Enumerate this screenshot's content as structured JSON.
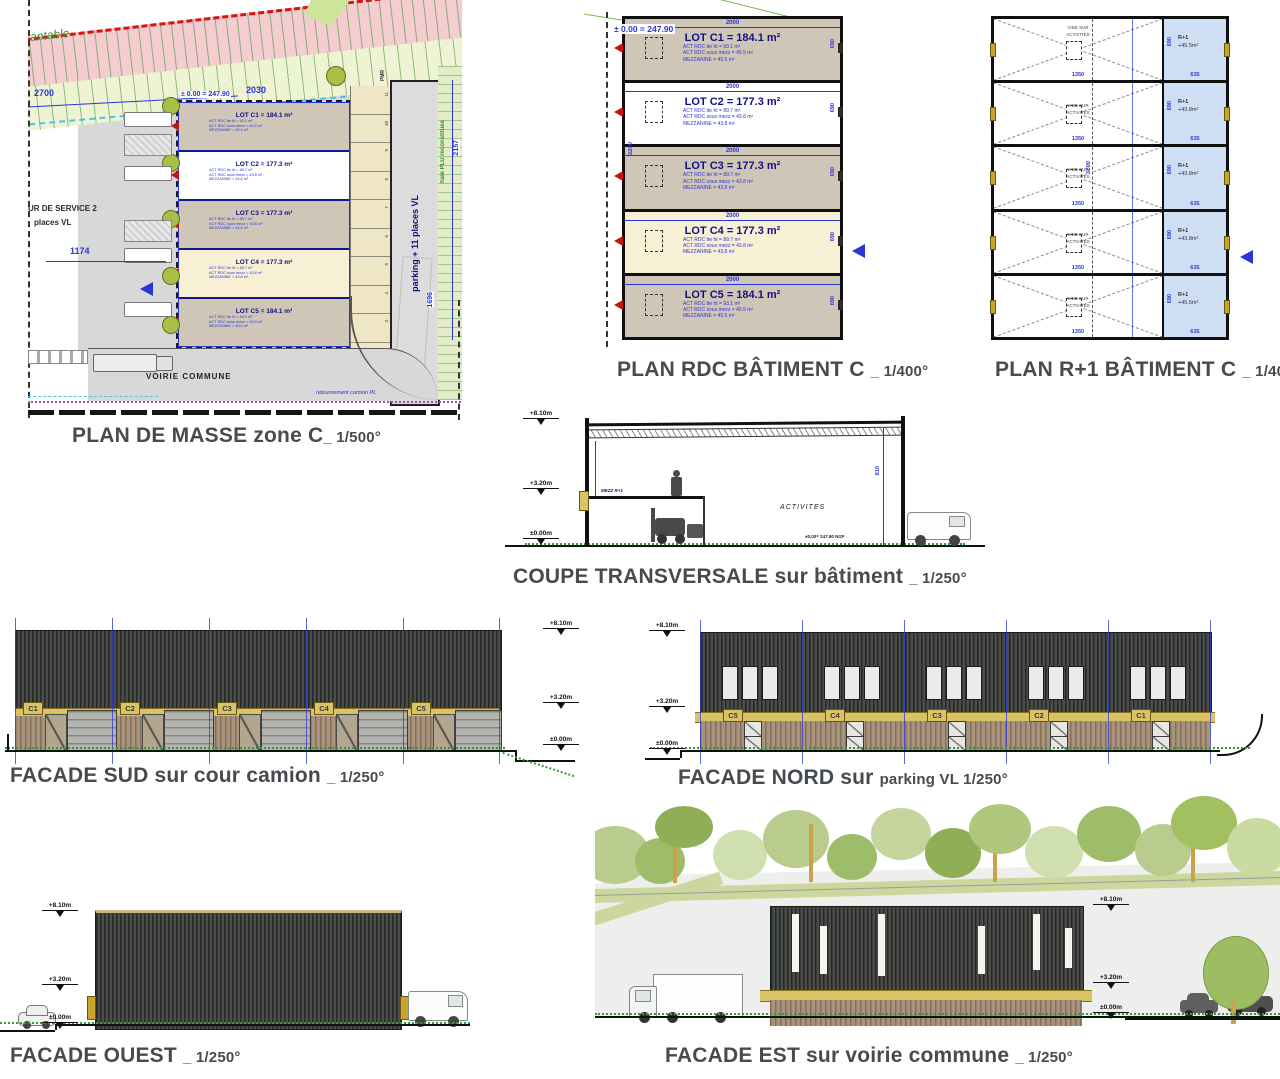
{
  "titles": {
    "masse": {
      "main": "PLAN DE MASSE zone C",
      "scale": "_ 1/500°"
    },
    "rdc": {
      "main": "PLAN RDC BÂTIMENT C ",
      "scale": "_ 1/400°"
    },
    "r1": {
      "main": "PLAN R+1 BÂTIMENT C ",
      "scale": "_ 1/400°"
    },
    "coupe": {
      "main": "COUPE TRANSVERSALE sur bâtiment ",
      "scale": "_ 1/250°"
    },
    "sud": {
      "main": "FACADE SUD sur cour camion ",
      "scale": "_ 1/250°"
    },
    "nord": {
      "main": "FACADE NORD sur ",
      "scale": "parking VL 1/250°"
    },
    "ouest": {
      "main": "FACADE OUEST ",
      "scale": "_ 1/250°"
    },
    "est": {
      "main": "FACADE EST sur voirie commune ",
      "scale": "_ 1/250°"
    }
  },
  "levels": {
    "l8": "+8.10m",
    "l3": "+3.20m",
    "l0": "±0.00m"
  },
  "masse": {
    "plantable": "antable",
    "dim_2700": "2700",
    "dim_2030": "2030",
    "dim_1174": "1174",
    "dim_2157": "2157",
    "dim_1696": "1696",
    "level": "± 0.00 = 247.90",
    "service_line1": "UR DE SERVICE 2",
    "service_line2": "places VL",
    "voirie": "VOIRIE COMMUNE",
    "retournement": "retournement camion PL",
    "parking_label": "parking + 11 places VL",
    "haie": "haie PLU reconstituée",
    "pmr": "PMR",
    "stalls": [
      "11",
      "10",
      "9",
      "8",
      "7",
      "6",
      "5",
      "4",
      "3",
      "2",
      "1"
    ]
  },
  "rdc": {
    "level": "± 0.00 = 247.90",
    "overall_dim": "3200",
    "lots": [
      {
        "name": "LOT C1 = 184.1 m²",
        "line1": "ACT RDC tte ht = 93.1 m²",
        "line2": "ACT RDC sous mezz = 45.5 m²",
        "line3": "MEZZANINE = 45.5 m²",
        "width_dim": "2000",
        "height_dim": "690"
      },
      {
        "name": "LOT C2 = 177.3 m²",
        "line1": "ACT RDC tte ht = 89.7 m²",
        "line2": "ACT RDC sous mezz = 43.8 m²",
        "line3": "MEZZANINE = 43.8 m²",
        "width_dim": "2000",
        "height_dim": "690"
      },
      {
        "name": "LOT C3 = 177.3 m²",
        "line1": "ACT RDC tte ht = 89.7 m²",
        "line2": "ACT RDC sous mezz = 43.8 m²",
        "line3": "MEZZANINE = 43.8 m²",
        "width_dim": "2000",
        "height_dim": "690"
      },
      {
        "name": "LOT C4 = 177.3 m²",
        "line1": "ACT RDC tte ht = 89.7 m²",
        "line2": "ACT RDC sous mezz = 43.8 m²",
        "line3": "MEZZANINE = 43.8 m²",
        "width_dim": "2000",
        "height_dim": "690"
      },
      {
        "name": "LOT C5 = 184.1 m²",
        "line1": "ACT RDC tte ht = 93.1 m²",
        "line2": "ACT RDC sous mezz = 45.5 m²",
        "line3": "MEZZANINE = 45.5 m²",
        "width_dim": "2000",
        "height_dim": "690"
      }
    ]
  },
  "r1": {
    "overall_dim": "3200",
    "bays": [
      {
        "void_line1": "VIDE SUR",
        "void_line2": "ACTIVITES",
        "width_dim": "1350",
        "tag": "R+1",
        "area": "+45.5m²",
        "right_dim": "635",
        "height_dim": "690"
      },
      {
        "void_line1": "VIDE SUR",
        "void_line2": "ACTIVITES",
        "width_dim": "1350",
        "tag": "R+1",
        "area": "+43.8m²",
        "right_dim": "635",
        "height_dim": "690"
      },
      {
        "void_line1": "VIDE SUR",
        "void_line2": "ACTIVITES",
        "width_dim": "1350",
        "tag": "R+1",
        "area": "+43.8m²",
        "right_dim": "635",
        "height_dim": "690"
      },
      {
        "void_line1": "VIDE SUR",
        "void_line2": "ACTIVITES",
        "width_dim": "1350",
        "tag": "R+1",
        "area": "+43.8m²",
        "right_dim": "635",
        "height_dim": "690"
      },
      {
        "void_line1": "VIDE SUR",
        "void_line2": "ACTIVITES",
        "width_dim": "1350",
        "tag": "R+1",
        "area": "+45.5m²",
        "right_dim": "635",
        "height_dim": "690"
      }
    ]
  },
  "coupe": {
    "mezz": "MEZZ R+1",
    "activities": "ACTIVITES",
    "ngf": "±0.00= 247.90 NGF",
    "right_dim": "810"
  },
  "sud": {
    "bays": [
      "C1",
      "C2",
      "C3",
      "C4",
      "C5"
    ]
  },
  "nord": {
    "bays": [
      "C5",
      "C4",
      "C3",
      "C2",
      "C1"
    ]
  },
  "colors": {
    "dim_blue": "#2a35d6",
    "wall_dark": "#3d403d",
    "wood": "#9b8971",
    "band_yellow": "#d9c365",
    "lot_tan": "#d0c6b7",
    "lot_cream": "#f7f0d4",
    "r1_blue": "#cfdff3",
    "boundary_red": "#dd1111",
    "hedge_green": "#3e8c2f"
  }
}
